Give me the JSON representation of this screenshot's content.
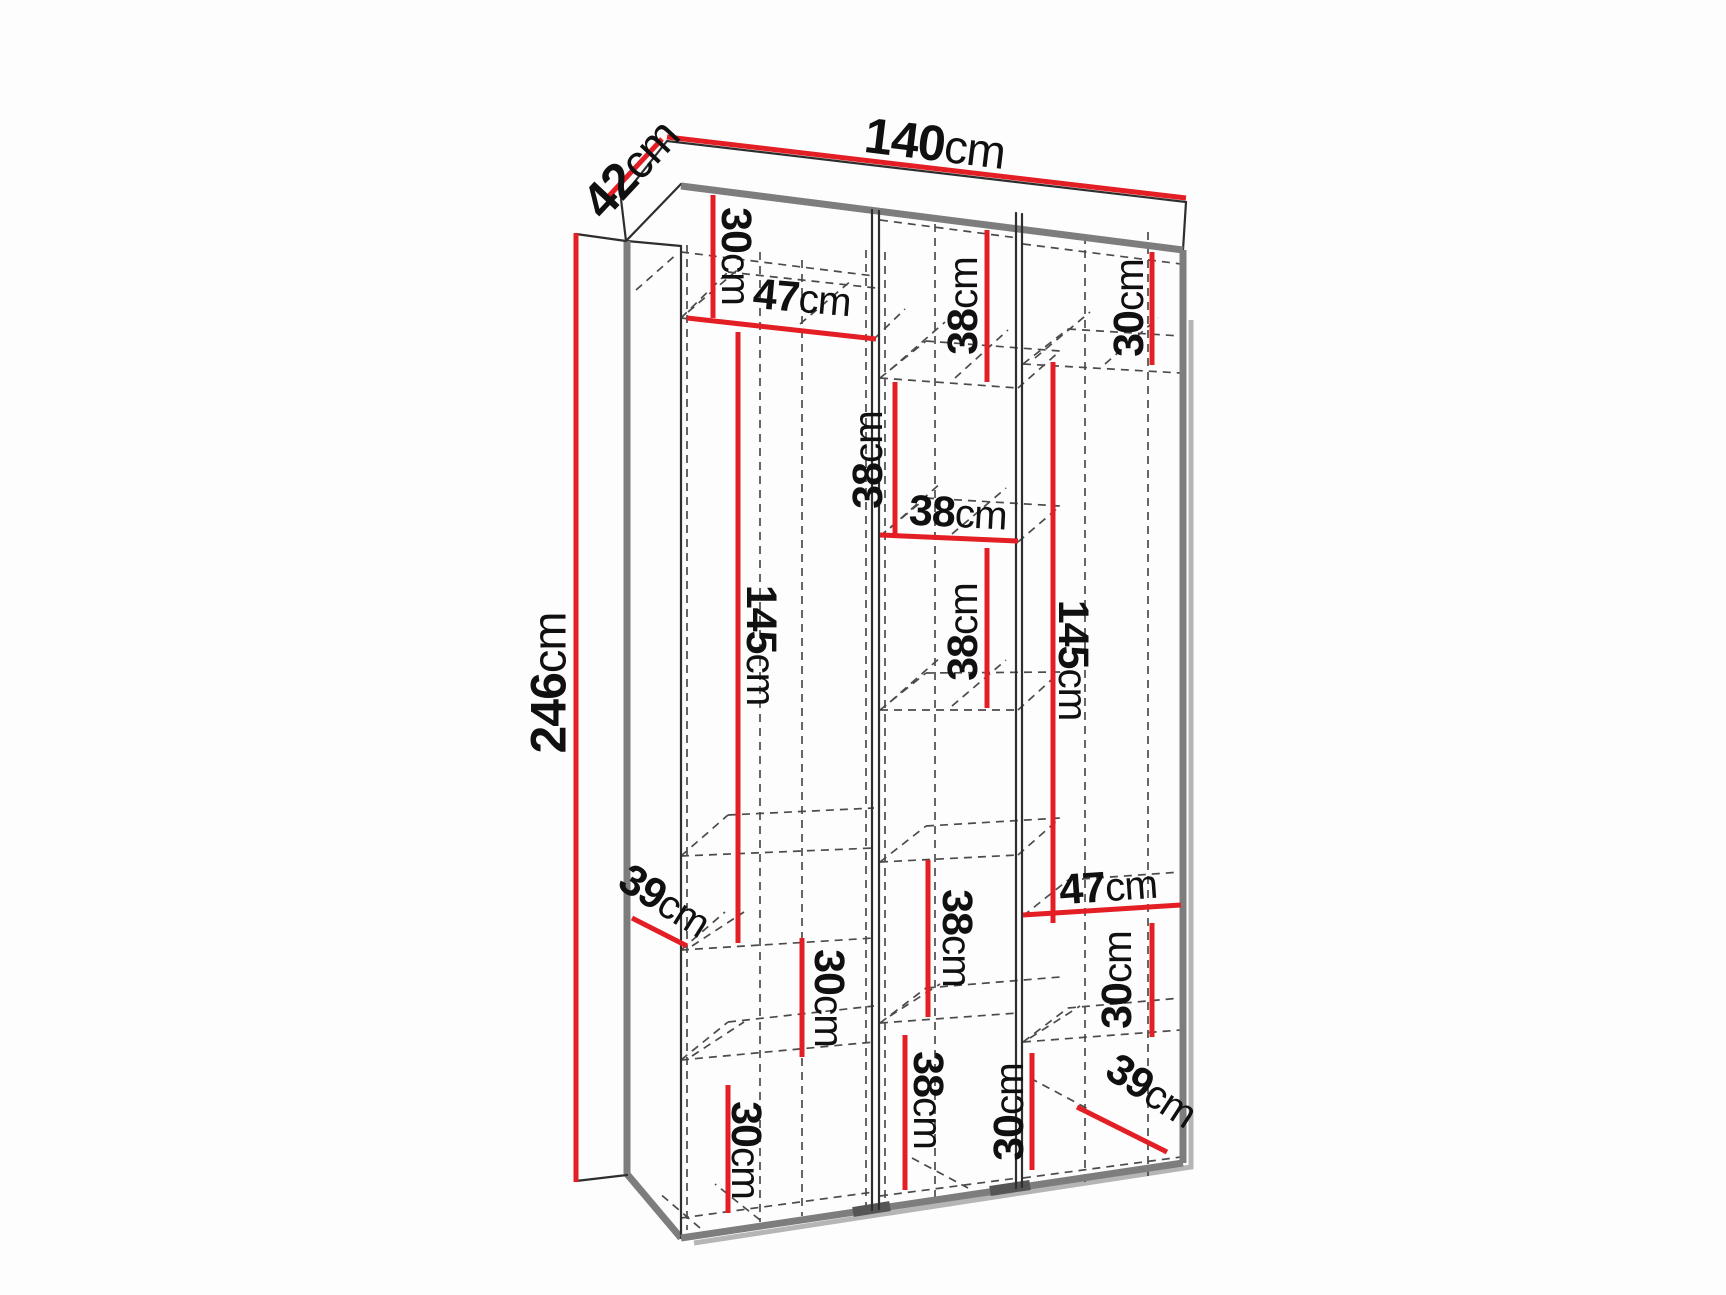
{
  "diagram": {
    "title": "wardrobe-dimension-diagram",
    "units": "cm",
    "accent_color": "#e31e24",
    "overall_dimensions": {
      "width": "140cm",
      "depth": "42cm",
      "height": "246cm"
    },
    "canvas": {
      "width": 1726,
      "height": 1295
    },
    "labels": [
      {
        "id": "depth-42",
        "value": "42",
        "unit": "cm",
        "x": 630,
        "y": 168,
        "rotate": -47,
        "size": 50
      },
      {
        "id": "width-140",
        "value": "140",
        "unit": "cm",
        "x": 935,
        "y": 143,
        "rotate": 7,
        "size": 50
      },
      {
        "id": "height-246",
        "value": "246",
        "unit": "cm",
        "x": 548,
        "y": 683,
        "rotate": -90,
        "size": 50
      },
      {
        "id": "shelf-30-top-left",
        "value": "30",
        "unit": "cm",
        "x": 737,
        "y": 256,
        "rotate": 90,
        "size": 43
      },
      {
        "id": "shelf-47-left",
        "value": "47",
        "unit": "cm",
        "x": 802,
        "y": 297,
        "rotate": 5,
        "size": 43
      },
      {
        "id": "shelf-38-top-mid",
        "value": "38",
        "unit": "cm",
        "x": 962,
        "y": 306,
        "rotate": -90,
        "size": 43
      },
      {
        "id": "shelf-30-top-right",
        "value": "30",
        "unit": "cm",
        "x": 1128,
        "y": 308,
        "rotate": -90,
        "size": 43
      },
      {
        "id": "shelf-38-mid-upper",
        "value": "38",
        "unit": "cm",
        "x": 867,
        "y": 460,
        "rotate": -90,
        "size": 43
      },
      {
        "id": "shelf-38-mid-horiz",
        "value": "38",
        "unit": "cm",
        "x": 958,
        "y": 512,
        "rotate": 3,
        "size": 43
      },
      {
        "id": "shelf-38-mid-2",
        "value": "38",
        "unit": "cm",
        "x": 962,
        "y": 632,
        "rotate": -90,
        "size": 43
      },
      {
        "id": "hang-145-left",
        "value": "145",
        "unit": "cm",
        "x": 762,
        "y": 645,
        "rotate": 90,
        "size": 43
      },
      {
        "id": "hang-145-right",
        "value": "145",
        "unit": "cm",
        "x": 1074,
        "y": 660,
        "rotate": 90,
        "size": 43
      },
      {
        "id": "shelf-38-mid-3",
        "value": "38",
        "unit": "cm",
        "x": 958,
        "y": 938,
        "rotate": 90,
        "size": 43
      },
      {
        "id": "depth-39-left",
        "value": "39",
        "unit": "cm",
        "x": 665,
        "y": 900,
        "rotate": 32,
        "size": 43
      },
      {
        "id": "shelf-30-left-mid",
        "value": "30",
        "unit": "cm",
        "x": 830,
        "y": 998,
        "rotate": 90,
        "size": 43
      },
      {
        "id": "shelf-47-right",
        "value": "47",
        "unit": "cm",
        "x": 1108,
        "y": 886,
        "rotate": -4,
        "size": 43
      },
      {
        "id": "shelf-30-right",
        "value": "30",
        "unit": "cm",
        "x": 1116,
        "y": 980,
        "rotate": -90,
        "size": 43
      },
      {
        "id": "shelf-30-bot-left",
        "value": "30",
        "unit": "cm",
        "x": 747,
        "y": 1150,
        "rotate": 90,
        "size": 43
      },
      {
        "id": "shelf-38-bot-mid",
        "value": "38",
        "unit": "cm",
        "x": 929,
        "y": 1100,
        "rotate": 90,
        "size": 43
      },
      {
        "id": "shelf-30-bot-mid",
        "value": "30",
        "unit": "cm",
        "x": 1008,
        "y": 1112,
        "rotate": -90,
        "size": 43
      },
      {
        "id": "depth-39-right",
        "value": "39",
        "unit": "cm",
        "x": 1152,
        "y": 1090,
        "rotate": 33,
        "size": 43
      }
    ],
    "dimension_lines": [
      {
        "id": "line-42",
        "x1": 608,
        "y1": 197,
        "x2": 662,
        "y2": 139
      },
      {
        "id": "line-140",
        "x1": 667,
        "y1": 137,
        "x2": 1186,
        "y2": 198
      },
      {
        "id": "line-246",
        "x1": 576,
        "y1": 233,
        "x2": 576,
        "y2": 1182
      },
      {
        "id": "line-30-top-left",
        "x1": 713,
        "y1": 195,
        "x2": 713,
        "y2": 318
      },
      {
        "id": "line-47-left",
        "x1": 687,
        "y1": 318,
        "x2": 876,
        "y2": 339
      },
      {
        "id": "line-38-top-mid",
        "x1": 987,
        "y1": 230,
        "x2": 987,
        "y2": 382
      },
      {
        "id": "line-30-top-right",
        "x1": 1152,
        "y1": 252,
        "x2": 1152,
        "y2": 365
      },
      {
        "id": "line-38-mid-upper",
        "x1": 895,
        "y1": 382,
        "x2": 895,
        "y2": 535
      },
      {
        "id": "line-38-mid-horiz",
        "x1": 880,
        "y1": 535,
        "x2": 1018,
        "y2": 541
      },
      {
        "id": "line-38-mid-2",
        "x1": 987,
        "y1": 548,
        "x2": 987,
        "y2": 708
      },
      {
        "id": "line-145-left",
        "x1": 738,
        "y1": 332,
        "x2": 738,
        "y2": 943
      },
      {
        "id": "line-145-right",
        "x1": 1053,
        "y1": 362,
        "x2": 1053,
        "y2": 923
      },
      {
        "id": "line-38-mid-3",
        "x1": 928,
        "y1": 860,
        "x2": 928,
        "y2": 1017
      },
      {
        "id": "line-39-left",
        "x1": 632,
        "y1": 918,
        "x2": 687,
        "y2": 946
      },
      {
        "id": "line-30-left-mid",
        "x1": 802,
        "y1": 938,
        "x2": 802,
        "y2": 1057
      },
      {
        "id": "line-47-right",
        "x1": 1023,
        "y1": 915,
        "x2": 1181,
        "y2": 905
      },
      {
        "id": "line-30-right",
        "x1": 1152,
        "y1": 923,
        "x2": 1152,
        "y2": 1037
      },
      {
        "id": "line-30-bot-left",
        "x1": 728,
        "y1": 1085,
        "x2": 728,
        "y2": 1213
      },
      {
        "id": "line-38-bot-mid",
        "x1": 905,
        "y1": 1035,
        "x2": 905,
        "y2": 1190
      },
      {
        "id": "line-30-bot-mid",
        "x1": 1032,
        "y1": 1053,
        "x2": 1032,
        "y2": 1170
      },
      {
        "id": "line-39-right",
        "x1": 1077,
        "y1": 1107,
        "x2": 1167,
        "y2": 1152
      }
    ]
  }
}
